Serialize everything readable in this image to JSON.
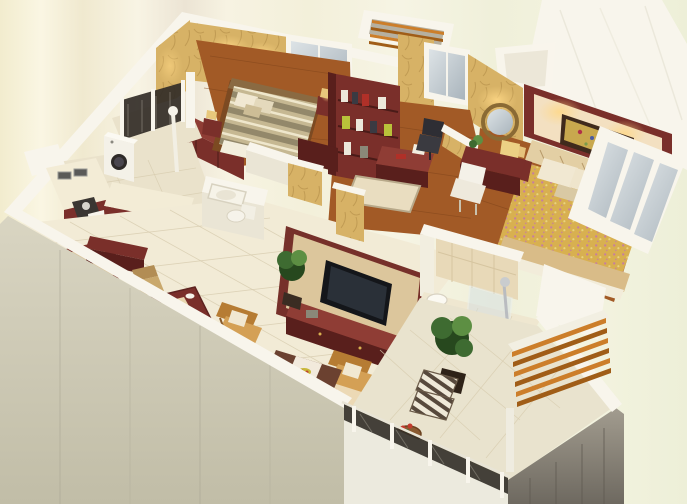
{
  "scene": {
    "description": "Photorealistic 3D isometric cut-away floor plan render of an apartment viewed from above; the image contains no rendered text, labels or UI controls",
    "rooms": [
      {
        "name": "second-bedroom",
        "floor": "dark wood",
        "furniture": [
          "double bed with striped duvet",
          "maroon wardrobe",
          "two framed pictures",
          "back window",
          "bedside tables with lamps"
        ]
      },
      {
        "name": "study",
        "floor": "dark wood",
        "furniture": [
          "maroon bookshelf wall unit with books and lime boxes",
          "writing desk with red book and lamp",
          "black office chair",
          "small area rug",
          "window",
          "louvered AC shaft"
        ]
      },
      {
        "name": "master-bedroom",
        "floor": "dark wood",
        "furniture": [
          "double bed with floral cover and fabric runner",
          "cream feature wall with maroon frame and floral painting",
          "round gold mirror",
          "maroon dressing table with lamp",
          "white chair",
          "bedside chest with lamp",
          "slanted corner window wall"
        ]
      },
      {
        "name": "kitchen",
        "floor": "beige tile",
        "furniture": [
          "L-shaped counter",
          "double sink",
          "stove with kettle",
          "maroon base cabinets",
          "washing machine",
          "white utility pole"
        ]
      },
      {
        "name": "laundry-balcony",
        "floor": "tile",
        "furniture": [
          "dark lattice railing with white posts"
        ]
      },
      {
        "name": "entry-hallway",
        "floor": "cream tile",
        "furniture": [
          "patterned entry rug",
          "maroon console",
          "potted plant"
        ]
      },
      {
        "name": "small-bathroom",
        "floor": "tile",
        "furniture": [
          "bathtub",
          "toilet",
          "white half partition walls"
        ]
      },
      {
        "name": "dining-area",
        "floor": "cream tile",
        "furniture": [
          "maroon dining table with cream runner",
          "four wooden chairs",
          "place settings"
        ]
      },
      {
        "name": "living-room",
        "floor": "cream tile",
        "furniture": [
          "TV feature wall with flat screen TV",
          "maroon TV cabinet",
          "golden L-shaped sofa set with white pillows",
          "dark coffee table with white runner and fruit bowl",
          "large rug with ornate red border",
          "potted plant",
          "white sphere floor lamps"
        ]
      },
      {
        "name": "main-bathroom",
        "floor": "beige tile",
        "furniture": [
          "round washbasin",
          "chrome shower column",
          "glass partition",
          "tiled wall"
        ]
      },
      {
        "name": "balcony",
        "floor": "pale diagonal tile",
        "furniture": [
          "ornate dark metal railing with white posts",
          "two striped armchairs",
          "round wooden side table with red flowers",
          "large potted plant",
          "wooden slat pergola awning"
        ]
      }
    ],
    "palette": {
      "backgroundCream": "#f5f1da",
      "wallWhite": "#f8f5ec",
      "wallShade": "#eae5d5",
      "wallGrayFace": "#d5d1bc",
      "grayFascia": "#8d8779",
      "wallpaper": "#d7b266",
      "wallpaperDeep": "#a98440",
      "woodFloor": "#a25a26",
      "woodLine": "#7e431a",
      "tileCream": "#f2ebd6",
      "tileKitchen": "#eae2cb",
      "tileBalcony": "#e9e3ce",
      "tileLine": "#d8cdb0",
      "maroon": "#7a2f2a",
      "maroonDark": "#591f1c",
      "maroonLight": "#8f3d35",
      "sofaGold": "#d4a055",
      "sofaGoldDeep": "#b67c33",
      "creamFabric": "#f1e8d2",
      "rugField": "#ecd9b5",
      "rugBorder": "#b54a2b",
      "masterWallCream": "#f3e0c1",
      "bedFloral": "#d8b050",
      "bedFloralPink": "#c77f9e",
      "bedStripeA": "#c6b892",
      "bedStripeB": "#93886a",
      "bedStripeC": "#efe7cc",
      "plantGreen": "#3e6b31",
      "plantGreenDark": "#27481e",
      "plantGreenLight": "#5d8f43",
      "darkMetal": "#322d27",
      "chrome": "#b9bcc0",
      "glassBlue": "#c4cdd3",
      "slatOrange": "#cc7e2a",
      "slatDark": "#a05d17",
      "lampGlow": "#ffd886"
    }
  }
}
